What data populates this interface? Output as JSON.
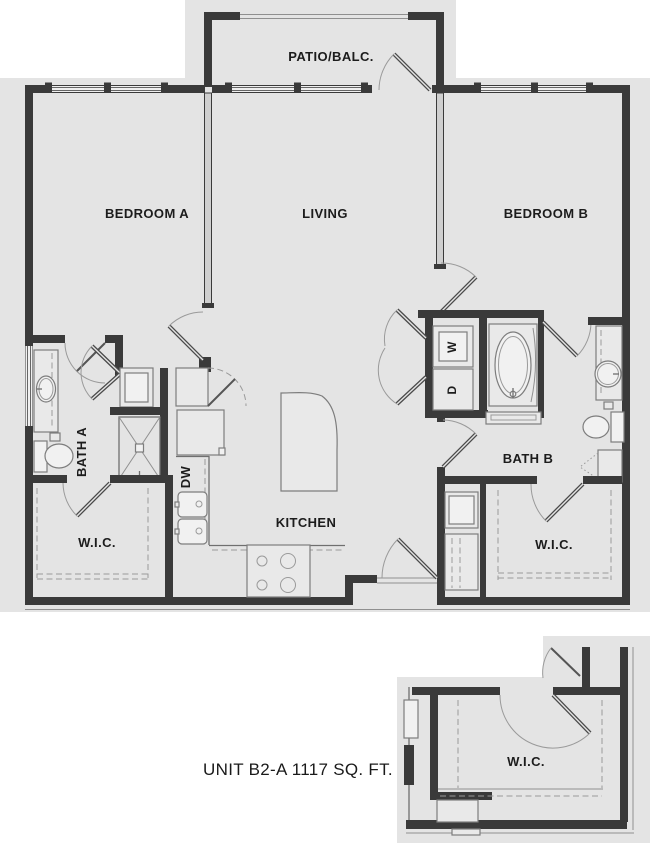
{
  "unit": {
    "id": "B2-A",
    "area_sqft": 1117,
    "caption": "UNIT B2-A 1117 SQ. FT."
  },
  "labels": {
    "patio": "PATIO/BALC.",
    "bedroom_a": "BEDROOM A",
    "living": "LIVING",
    "bedroom_b": "BEDROOM B",
    "bath_a": "BATH A",
    "bath_b": "BATH B",
    "kitchen": "KITCHEN",
    "wic_a": "W.I.C.",
    "wic_b": "W.I.C.",
    "wic_inset": "W.I.C.",
    "dishwasher": "DW",
    "washer": "W",
    "dryer": "D"
  },
  "colors": {
    "page_background": "#ffffff",
    "plan_background": "#e4e4e4",
    "wall": "#3a3a3a",
    "partition_fill": "#cfcfcf",
    "fixture_stroke": "#7d7d7d",
    "fixture_fill": "#e9e9e9",
    "thin_line": "#8f8f8f",
    "label_text": "#1c1c1c"
  }
}
